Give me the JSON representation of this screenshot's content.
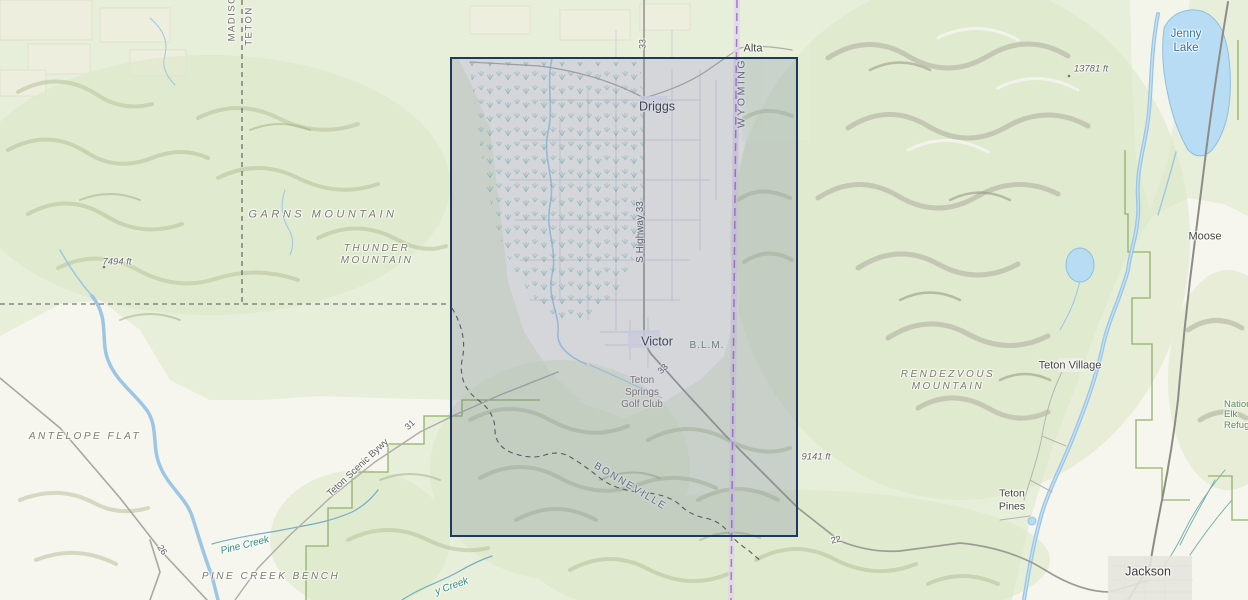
{
  "labels": {
    "county_madison": "MADISON",
    "county_teton": "TETON",
    "alta": "Alta",
    "driggs": "Driggs",
    "wyoming": "WYOMING",
    "jenny_lake": "Jenny\nLake",
    "elev_13781": "13781 ft",
    "garns_mountain": "GARNS MOUNTAIN",
    "thunder_mountain": "THUNDER\nMOUNTAIN",
    "elev_7494": "7494 ft",
    "s_highway_33": "S Highway 33",
    "route_33_top": "33",
    "moose": "Moose",
    "victor": "Victor",
    "blm": "B.L.M.",
    "teton_springs": "Teton\nSprings\nGolf Club",
    "route_33_victor": "33",
    "rendezvous_mountain": "RENDEZVOUS\nMOUNTAIN",
    "teton_village": "Teton Village",
    "antelope_flat": "ANTELOPE FLAT",
    "teton_scenic_bywy": "Teton Scenic Bywy",
    "route_31": "31",
    "bonneville": "BONNEVILLE",
    "elev_9141": "9141 ft",
    "route_22": "22",
    "teton_pines": "Teton\nPines",
    "national_elk_refuge": "National\nElk Refuge",
    "jackson": "Jackson",
    "pine_creek": "Pine Creek",
    "pine_creek_bench": "PINE CREEK BENCH",
    "creek_partial": "y Creek",
    "route_26": "26"
  },
  "colors": {
    "selection_border": "#1c3a5c",
    "selection_fill": "rgba(92,104,144,0.22)",
    "state_line_purple": "#a678c8",
    "water_blue": "#9cc6e6",
    "lake_fill": "#b8dcf4",
    "forest_green": "#e7eed9",
    "valley_white": "#f6f5ee",
    "park_boundary_green": "#8aab60"
  }
}
